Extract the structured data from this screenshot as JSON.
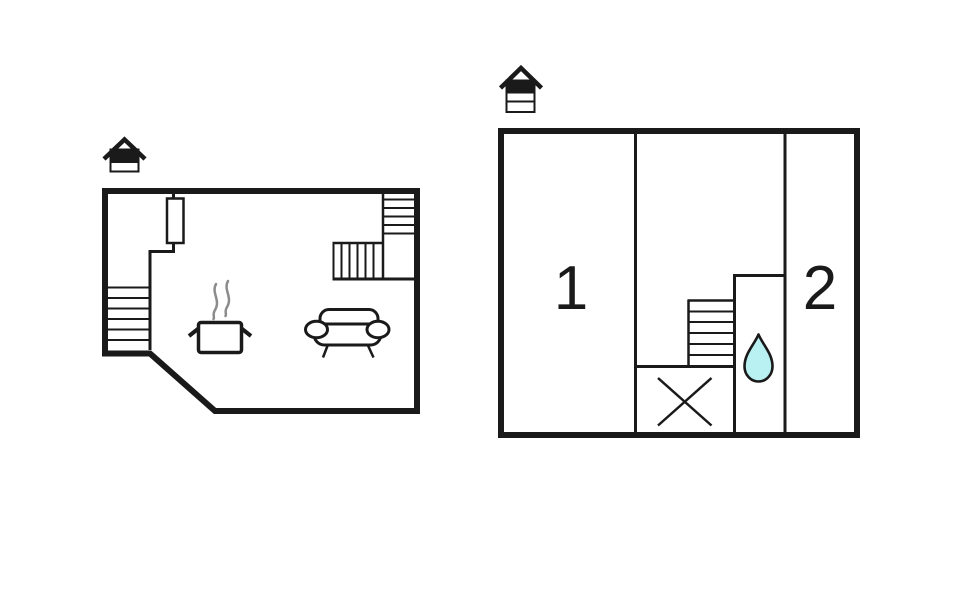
{
  "colors": {
    "background": "#ffffff",
    "line": "#1a1a1a",
    "steam": "#8c8c8c",
    "water_drop": "#b9f0f2"
  },
  "floor_plans": [
    {
      "name": "floor-plan-left",
      "level_icon": {
        "type": "house-level-indicator",
        "bands": 2,
        "highlighted_band": 1
      },
      "features": [
        "staircase-lower-left",
        "staircase-upper-right",
        "door",
        "stove-with-steam",
        "sofa"
      ],
      "room_labels": []
    },
    {
      "name": "floor-plan-right",
      "level_icon": {
        "type": "house-level-indicator",
        "bands": 3,
        "highlighted_band": 1
      },
      "features": [
        "staircase",
        "crossed-box",
        "water-drop"
      ],
      "room_labels": [
        "1",
        "2"
      ]
    }
  ]
}
